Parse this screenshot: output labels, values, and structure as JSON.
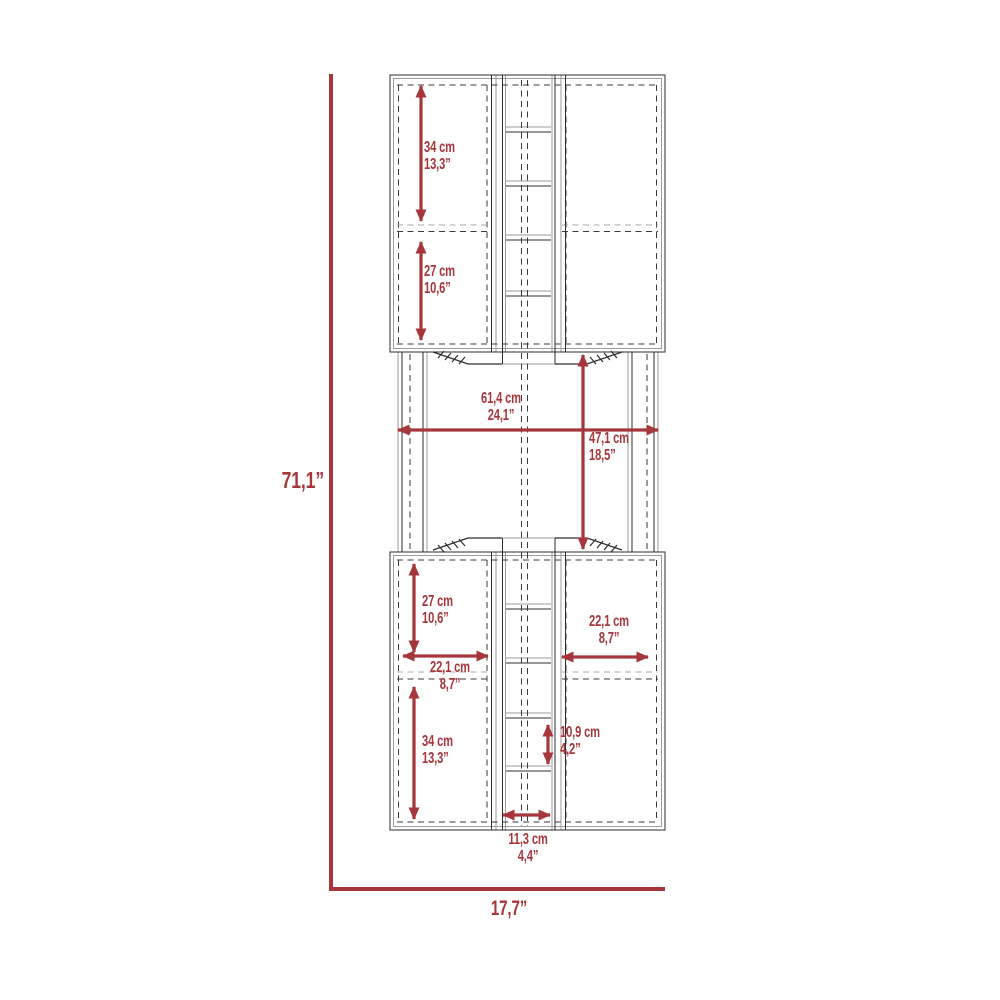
{
  "diagram": {
    "kind": "furniture dimension drawing",
    "accent_color": "#A6363B",
    "line_color": "#2E2E2E",
    "overall": {
      "height": "71,1”",
      "width": "17,7”"
    },
    "annotations": {
      "upper_top": {
        "cm": "34 cm",
        "inch": "13,3”"
      },
      "upper_bottom": {
        "cm": "27 cm",
        "inch": "10,6”"
      },
      "middle_width": {
        "cm": "61,4 cm",
        "inch": "24,1”"
      },
      "middle_height": {
        "cm": "47,1 cm",
        "inch": "18,5”"
      },
      "lower_top": {
        "cm": "27 cm",
        "inch": "10,6”"
      },
      "lower_left_width": {
        "cm": "22,1 cm",
        "inch": "8,7”"
      },
      "lower_right_width": {
        "cm": "22,1 cm",
        "inch": "8,7”"
      },
      "lower_bottom": {
        "cm": "34 cm",
        "inch": "13,3”"
      },
      "center_cubby_height": {
        "cm": "10,9 cm",
        "inch": "4,2”"
      },
      "center_column_width": {
        "cm": "11,3 cm",
        "inch": "4,4”"
      }
    }
  }
}
